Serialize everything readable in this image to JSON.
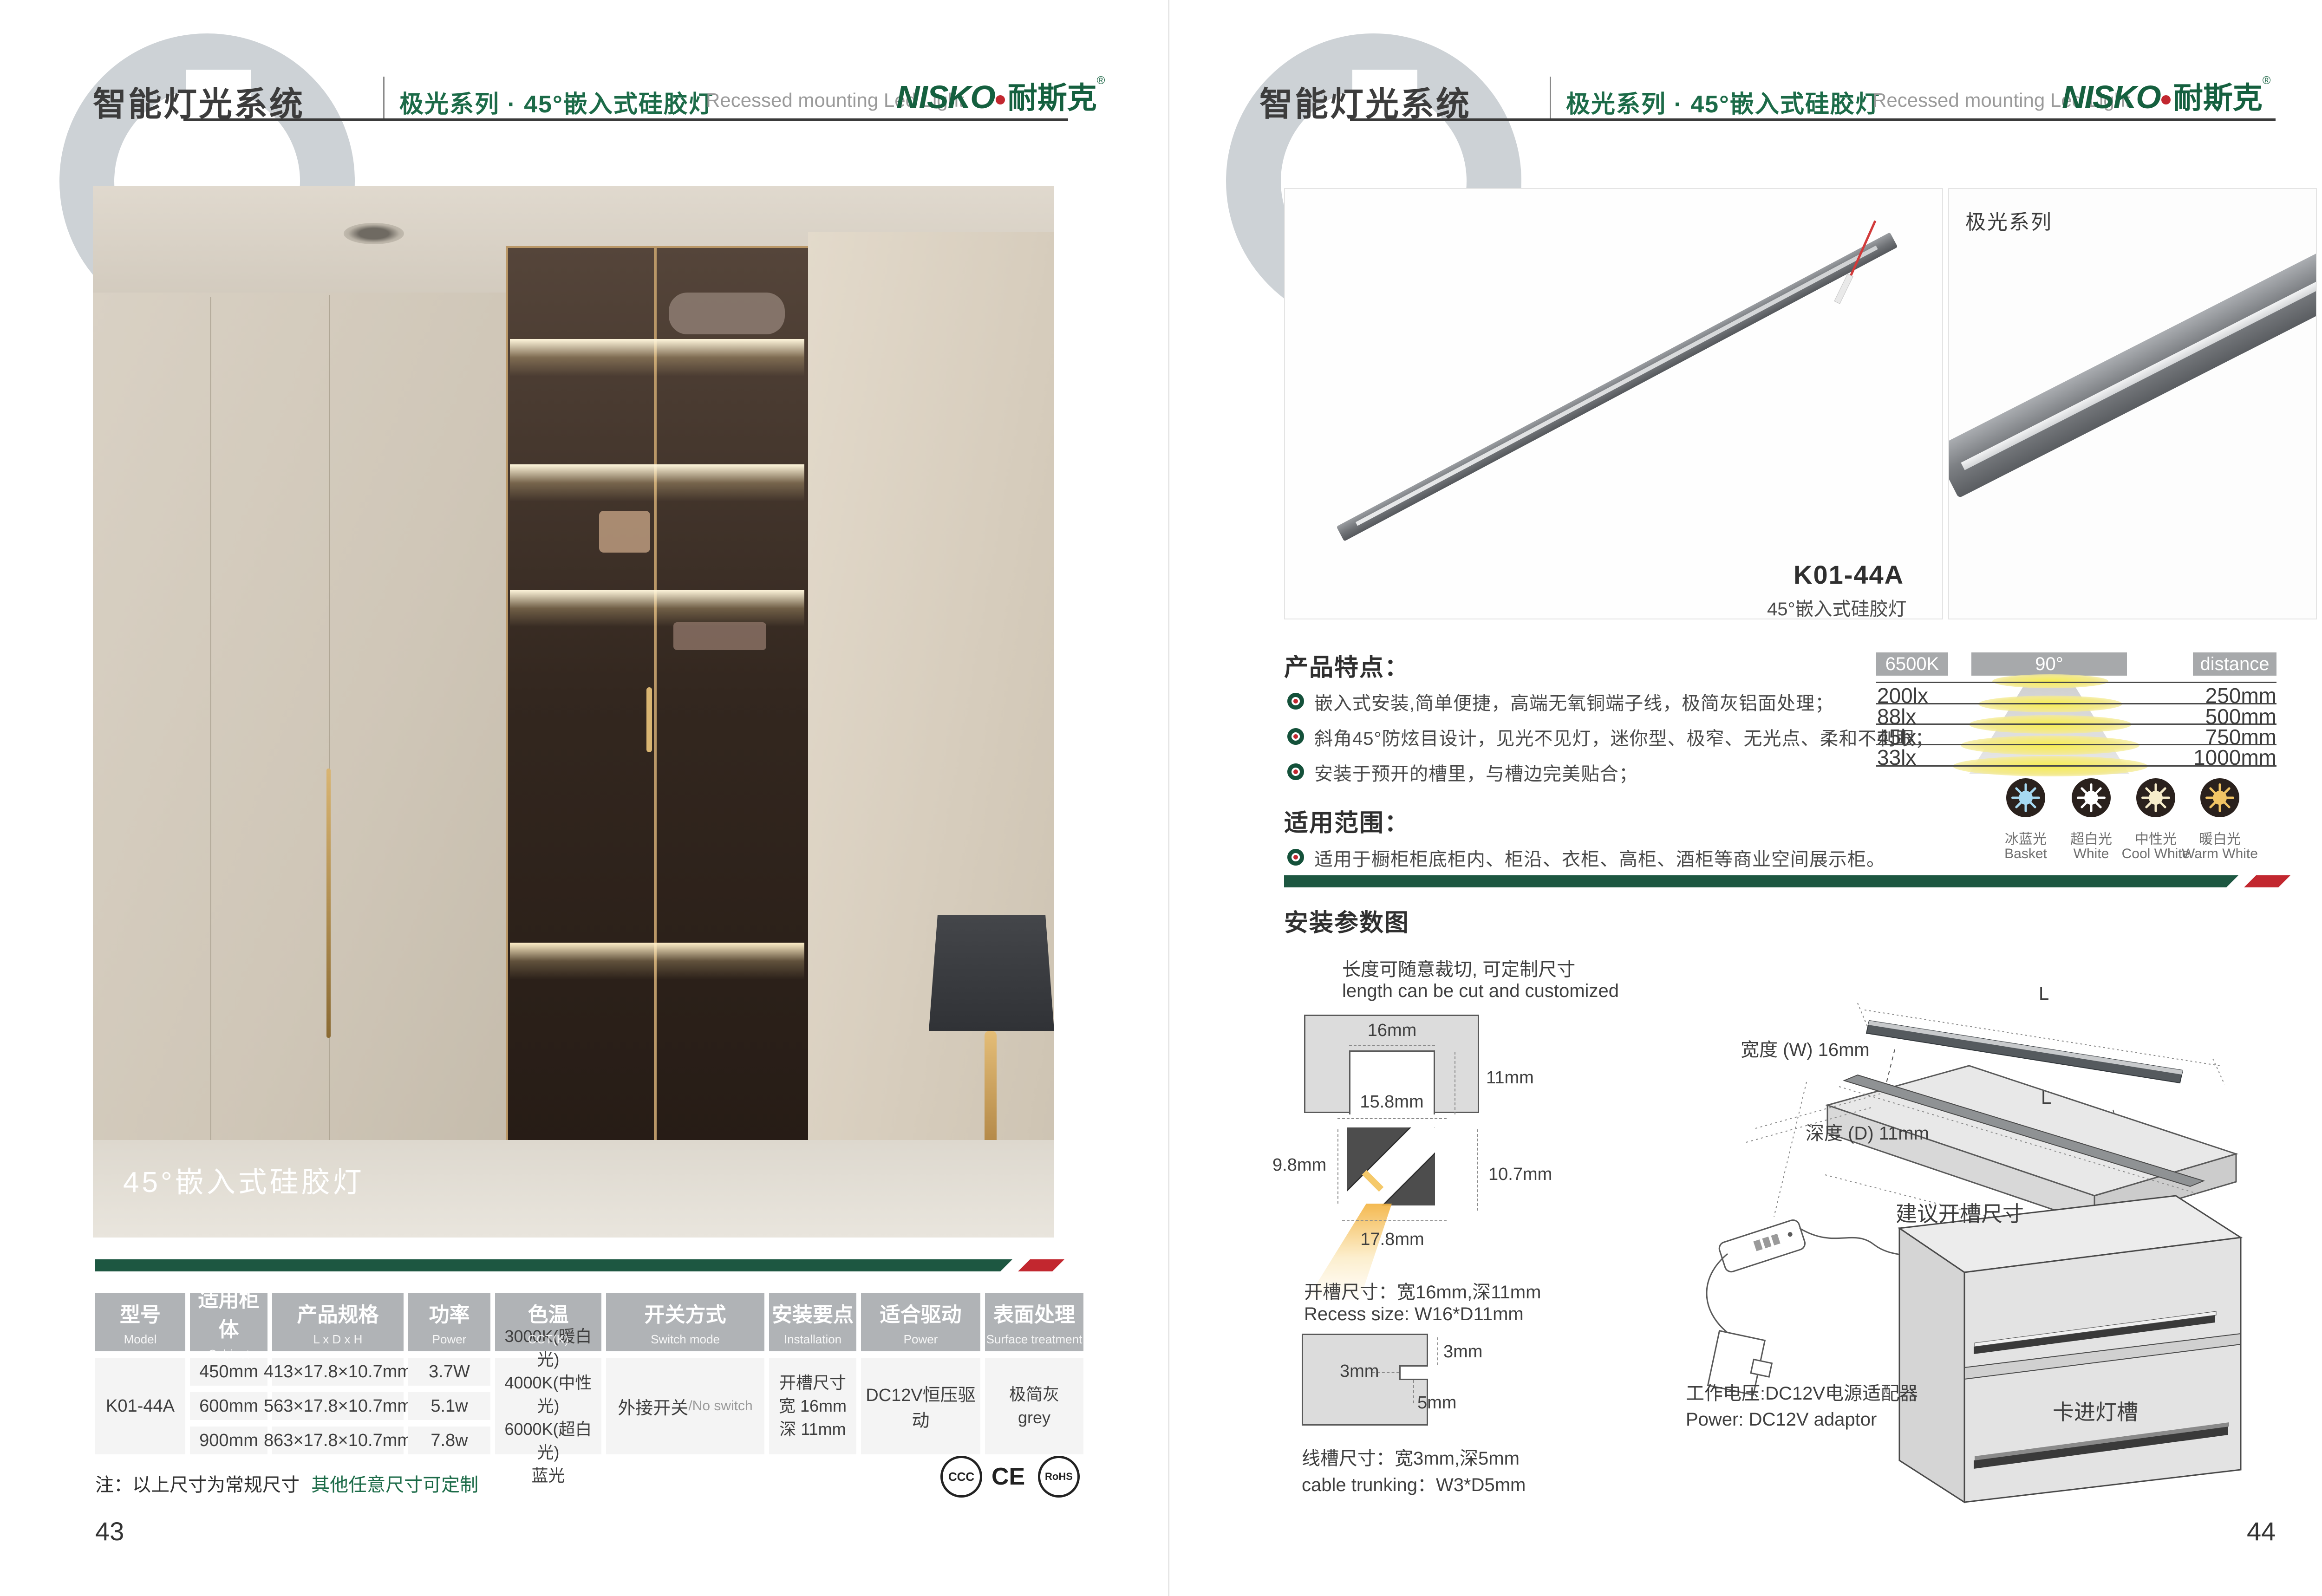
{
  "header": {
    "title": "智能灯光系统",
    "series": "极光系列 · 45°嵌入式硅胶灯",
    "series_en": "Recessed mounting Led Light",
    "logo_en": "NISKO",
    "logo_cn": "耐斯克",
    "logo_reg": "®"
  },
  "left_page": {
    "photo_caption": "45°嵌入式硅胶灯",
    "table": {
      "headers": [
        {
          "cn": "型号",
          "en": "Model"
        },
        {
          "cn": "适用柜体",
          "en": "Cabinet"
        },
        {
          "cn": "产品规格",
          "en": "L x D x H"
        },
        {
          "cn": "功率",
          "en": "Power"
        },
        {
          "cn": "色温",
          "en": "CCT(K)"
        },
        {
          "cn": "开关方式",
          "en": "Switch mode"
        },
        {
          "cn": "安装要点",
          "en": "Installation"
        },
        {
          "cn": "适合驱动",
          "en": "Power"
        },
        {
          "cn": "表面处理",
          "en": "Surface treatment"
        }
      ],
      "model": "K01-44A",
      "rows": [
        {
          "cabinet": "450mm",
          "spec": "413×17.8×10.7mm",
          "power": "3.7W"
        },
        {
          "cabinet": "600mm",
          "spec": "563×17.8×10.7mm",
          "power": "5.1w"
        },
        {
          "cabinet": "900mm",
          "spec": "863×17.8×10.7mm",
          "power": "7.8w"
        }
      ],
      "cct_lines": [
        "3000K(暖白光)",
        "4000K(中性光)",
        "6000K(超白光)",
        "蓝光"
      ],
      "switch_cn": "外接开关",
      "switch_en": "/No switch",
      "install_lines": [
        "开槽尺寸",
        "宽 16mm",
        "深 11mm"
      ],
      "driver": "DC12V恒压驱动",
      "surface_cn": "极简灰",
      "surface_en": "grey"
    },
    "note": "注：以上尺寸为常规尺寸",
    "note_highlight": "其他任意尺寸可定制",
    "certs": [
      "CCC",
      "CE",
      "RoHS"
    ],
    "page_number": "43"
  },
  "right_page": {
    "series_tag": "极光系列",
    "product_model": "K01-44A",
    "product_name": "45°嵌入式硅胶灯",
    "features_title": "产品特点：",
    "features": [
      "嵌入式安装,简单便捷，高端无氧铜端子线，极简灰铝面处理；",
      "斜角45°防炫目设计，见光不见灯，迷你型、极窄、无光点、柔和不刺眼；",
      "安装于预开的槽里，与槽边完美贴合；"
    ],
    "scope_title": "适用范围：",
    "scope": "适用于橱柜柜底柜内、柜沿、衣柜、高柜、酒柜等商业空间展示柜。",
    "photometric": {
      "cct": "6500K",
      "angle": "90°",
      "distance": "distance",
      "rows": [
        {
          "lux": "200lx",
          "mm": "250mm"
        },
        {
          "lux": "88lx",
          "mm": "500mm"
        },
        {
          "lux": "45lx",
          "mm": "750mm"
        },
        {
          "lux": "33lx",
          "mm": "1000mm"
        }
      ]
    },
    "swatches": [
      {
        "cn": "冰蓝光",
        "en": "Basket",
        "color": "#a6d9f2"
      },
      {
        "cn": "超白光",
        "en": "White",
        "color": "#ffffff"
      },
      {
        "cn": "中性光",
        "en": "Cool White",
        "color": "#f6ecca"
      },
      {
        "cn": "暖白光",
        "en": "Warm White",
        "color": "#f2c565"
      }
    ],
    "install_title": "安装参数图",
    "cut_cn": "长度可随意裁切, 可定制尺寸",
    "cut_en": "length can be cut and customized",
    "dims": {
      "top": "16mm",
      "side": "11mm",
      "inner": "15.8mm",
      "left": "9.8mm",
      "right": "10.7mm",
      "bottom": "17.8mm"
    },
    "recess_cn": "开槽尺寸：宽16mm,深11mm",
    "recess_en": "Recess size: W16*D11mm",
    "trunk": {
      "right": "3mm",
      "left": "3mm",
      "bottom": "5mm"
    },
    "trunk_cn": "线槽尺寸：宽3mm,深5mm",
    "trunk_en": "cable trunking：W3*D5mm",
    "len_label": "L",
    "width_label": "宽度 (W) 16mm",
    "depth_label": "深度 (D) 11mm",
    "suggest": "建议开槽尺寸",
    "power_cn": "工作电压:DC12V电源适配器",
    "power_en": "Power: DC12V adaptor",
    "clip": "卡进灯槽",
    "page_number": "44"
  },
  "colors": {
    "brand_green": "#1c6b48",
    "accent_red": "#c2272f",
    "bar_green": "#1d5741",
    "table_header_gray": "#b0b3b6",
    "photometric_gray": "#a7a9ab"
  }
}
